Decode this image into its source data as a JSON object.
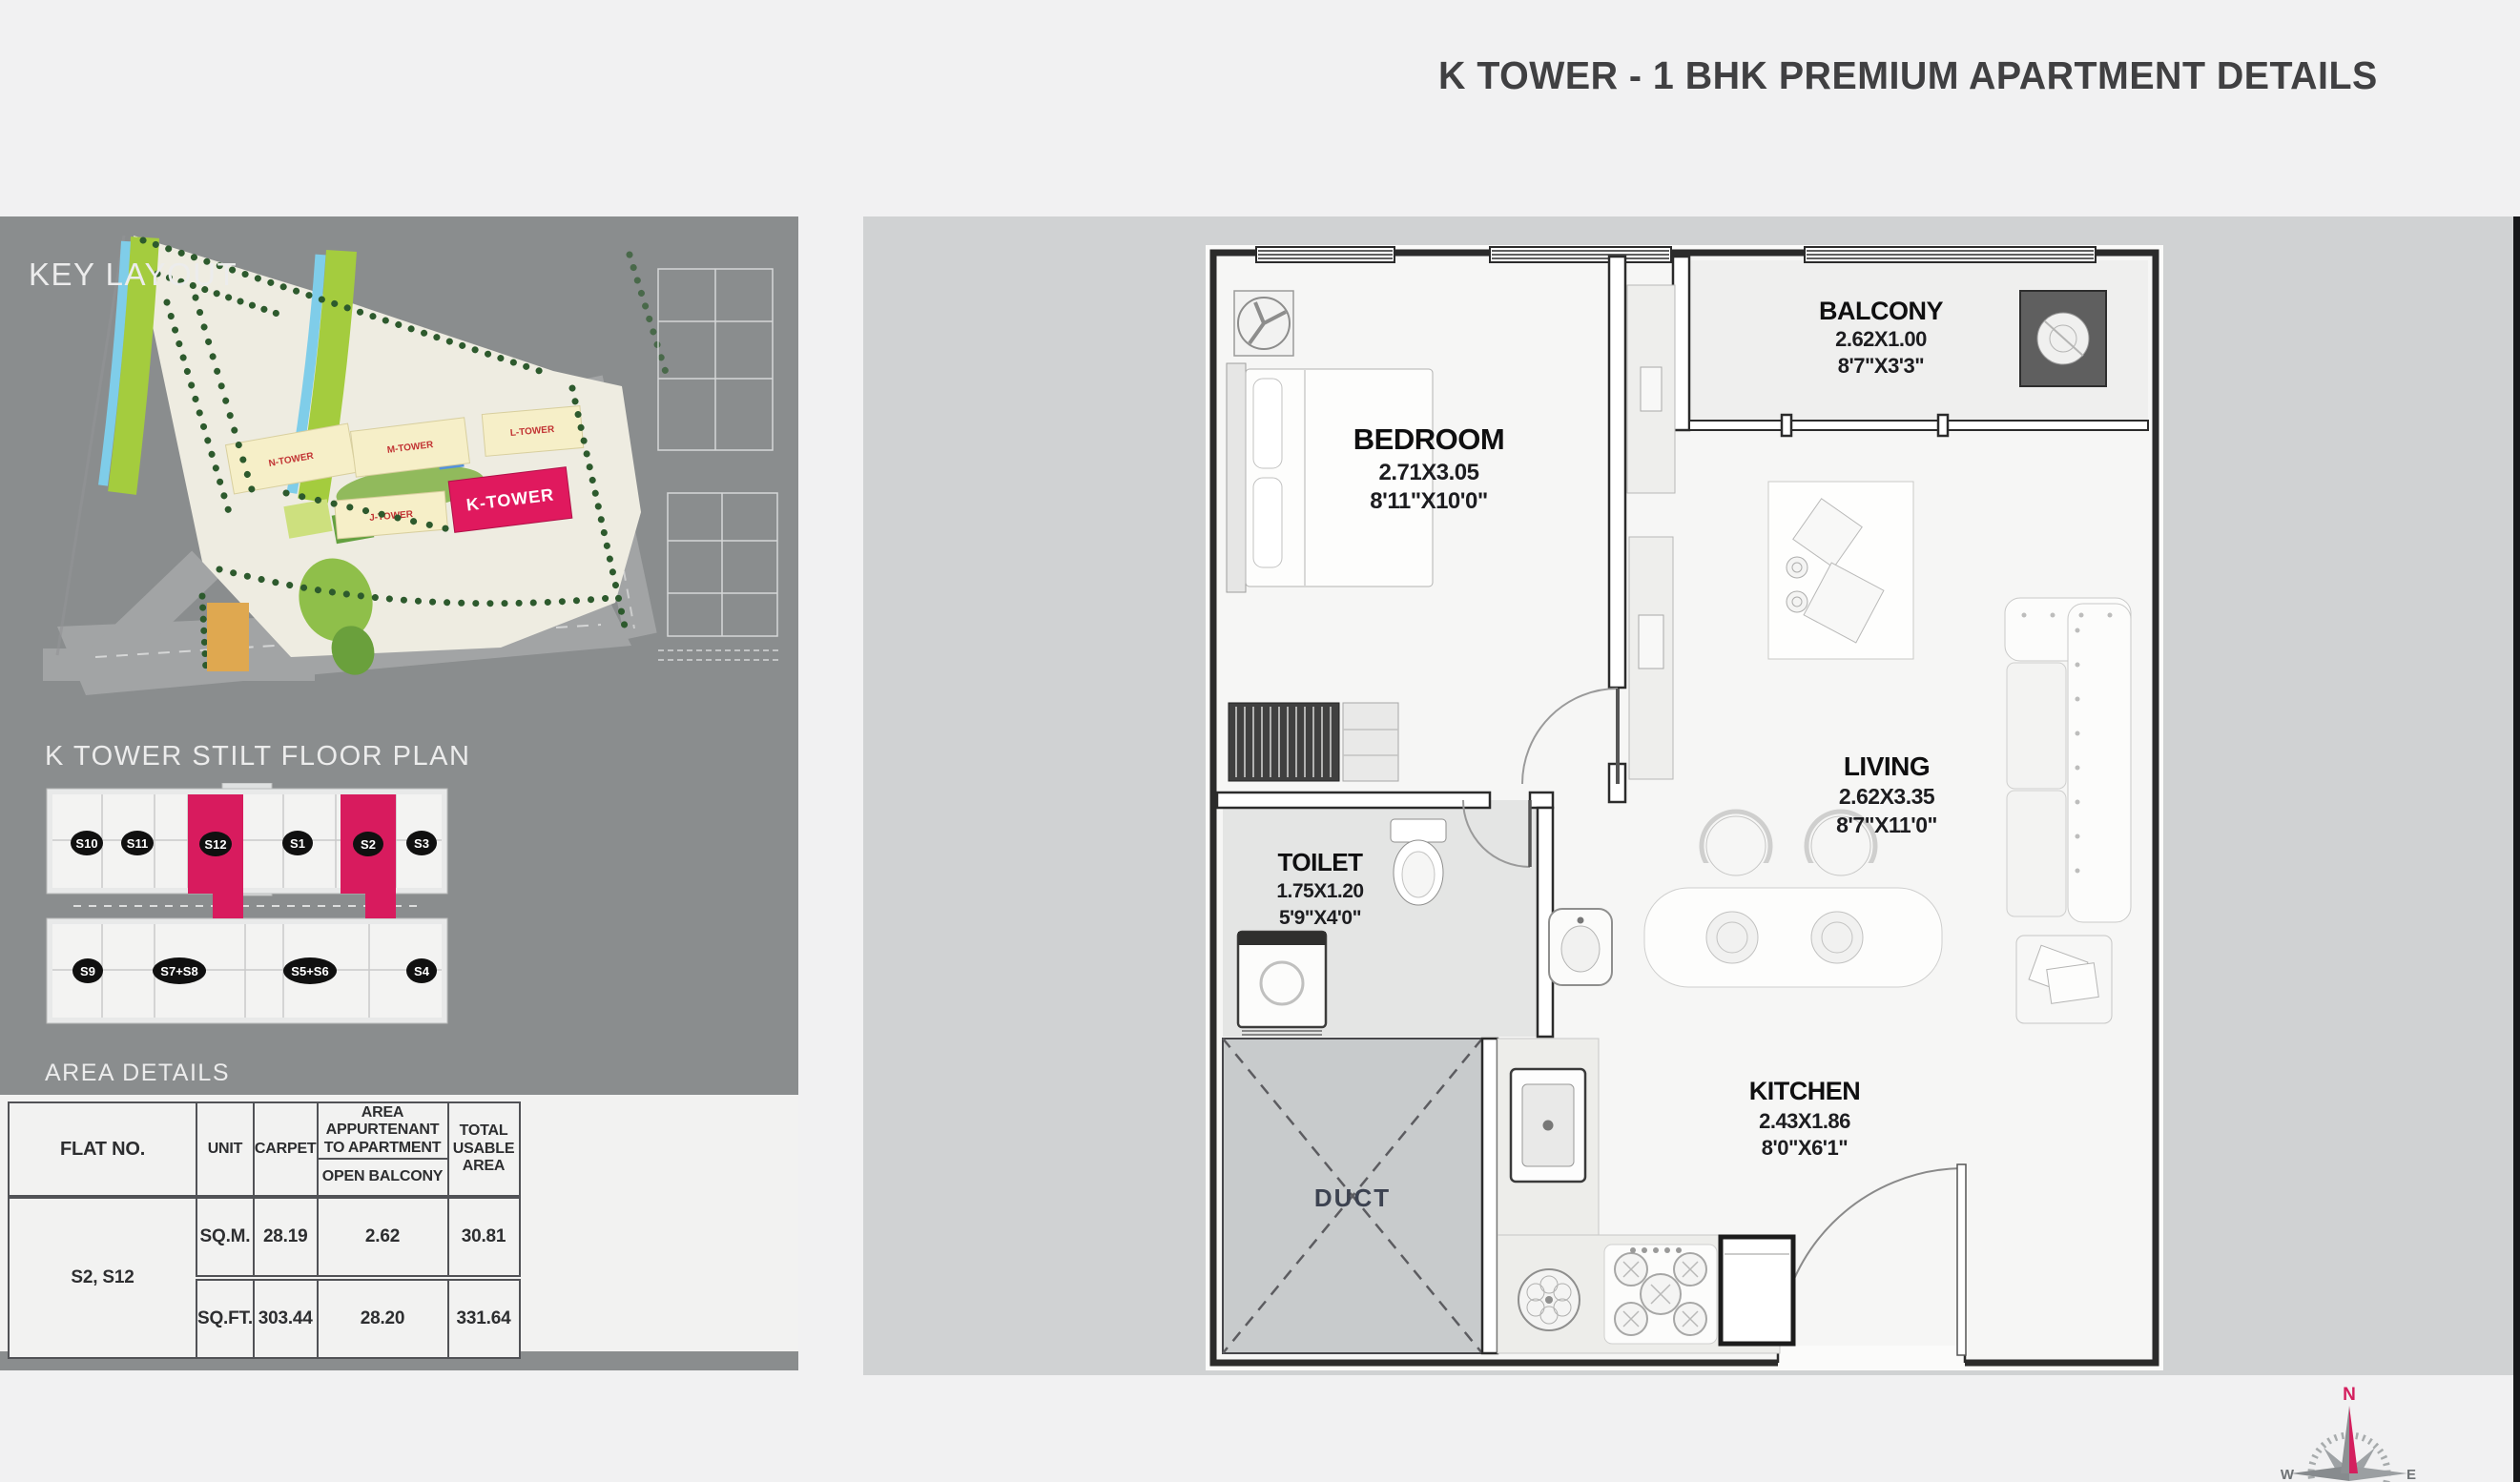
{
  "title": "K TOWER - 1 BHK PREMIUM APARTMENT DETAILS",
  "key_layout": {
    "heading": "KEY LAYOUT",
    "towers": {
      "n": "N-TOWER",
      "m": "M-TOWER",
      "l": "L-TOWER",
      "j": "J-TOWER",
      "k": "K-TOWER"
    }
  },
  "stilt_plan": {
    "heading": "K TOWER STILT FLOOR PLAN",
    "units_top": [
      "S10",
      "S11",
      "S12",
      "S1",
      "S2",
      "S3"
    ],
    "units_bottom": [
      "S9",
      "S7+S8",
      "S5+S6",
      "S4"
    ],
    "highlighted_units": "S12, S2"
  },
  "area_details": {
    "heading": "AREA DETAILS",
    "table": {
      "headers": {
        "flat_no": "FLAT NO.",
        "unit": "UNIT",
        "carpet": "CARPET",
        "area_appurtenant": "AREA APPURTENANT TO APARTMENT",
        "open_balcony": "OPEN BALCONY",
        "total_usable": "TOTAL USABLE AREA"
      },
      "flat_no": "S2, S12",
      "rows": [
        {
          "unit": "SQ.M.",
          "carpet": "28.19",
          "open_balcony": "2.62",
          "total": "30.81"
        },
        {
          "unit": "SQ.FT.",
          "carpet": "303.44",
          "open_balcony": "28.20",
          "total": "331.64"
        }
      ]
    }
  },
  "floor_plan": {
    "rooms": [
      {
        "name": "BEDROOM",
        "dim_m": "2.71X3.05",
        "dim_ft": "8'11\"X10'0\""
      },
      {
        "name": "BALCONY",
        "dim_m": "2.62X1.00",
        "dim_ft": "8'7\"X3'3\""
      },
      {
        "name": "LIVING",
        "dim_m": "2.62X3.35",
        "dim_ft": "8'7\"X11'0\""
      },
      {
        "name": "TOILET",
        "dim_m": "1.75X1.20",
        "dim_ft": "5'9\"X4'0\""
      },
      {
        "name": "KITCHEN",
        "dim_m": "2.43X1.86",
        "dim_ft": "8'0\"X6'1\""
      }
    ],
    "duct_label": "DUCT"
  },
  "compass": {
    "north": "N",
    "east": "E",
    "west": "W"
  },
  "colors": {
    "accent_pink": "#E0195E",
    "left_panel_gray": "#8A8D8E",
    "right_panel_gray": "#D0D2D3",
    "page_bg": "#F1F1F2",
    "wall_dark": "#2B2B2B"
  }
}
